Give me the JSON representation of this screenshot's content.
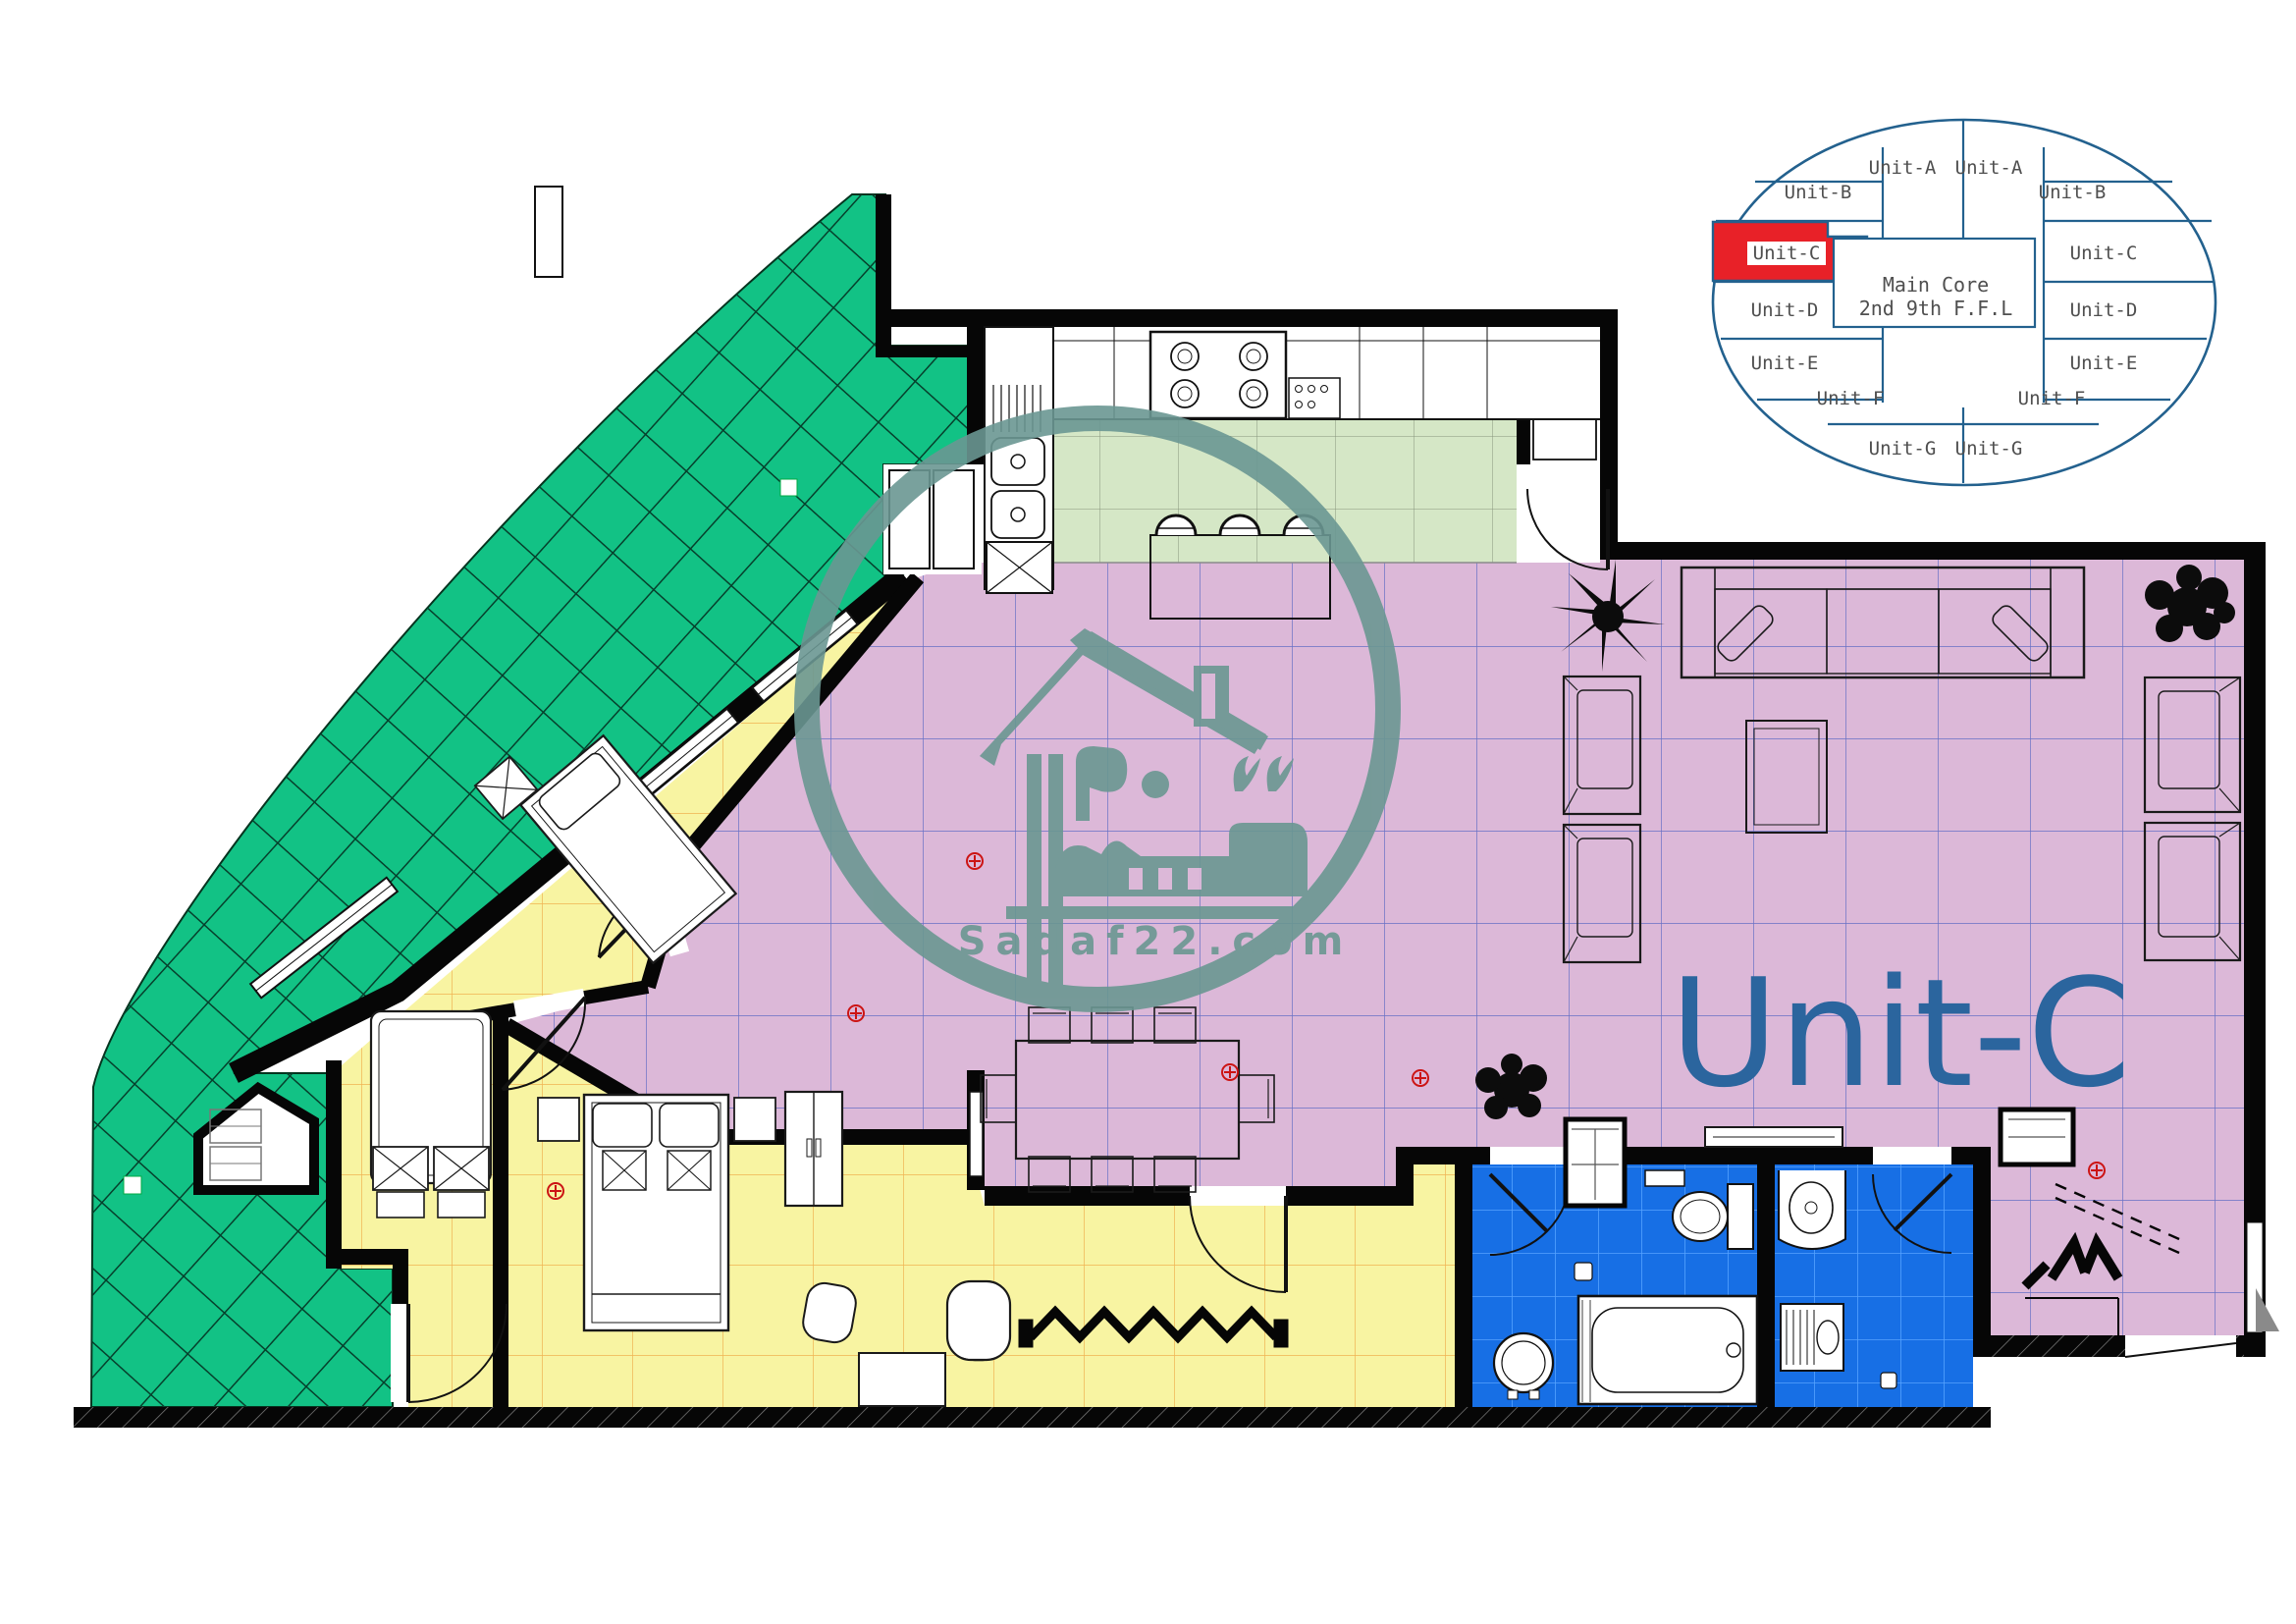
{
  "plan": {
    "unit_label": "Unit-C",
    "rooms": [
      {
        "name": "terrace",
        "color": "#12C285"
      },
      {
        "name": "kitchen",
        "color": "#D5E7C6"
      },
      {
        "name": "living-dining",
        "color": "#DCB8D8"
      },
      {
        "name": "bedroom-1",
        "color": "#F8F4A2"
      },
      {
        "name": "bedroom-2",
        "color": "#F8F4A2"
      },
      {
        "name": "master-bedroom",
        "color": "#F8F4A2"
      },
      {
        "name": "bathroom-1",
        "color": "#176FE5"
      },
      {
        "name": "bathroom-2",
        "color": "#176FE5"
      }
    ]
  },
  "key_plan": {
    "core_label_line1": "Main Core",
    "core_label_line2": "2nd  9th F.F.L",
    "highlighted_unit": "Unit-C",
    "outline_color": "#23618E",
    "highlight_color": "#E82128",
    "units": [
      {
        "label": "Unit-A"
      },
      {
        "label": "Unit-A"
      },
      {
        "label": "Unit-B"
      },
      {
        "label": "Unit-B"
      },
      {
        "label": "Unit-C",
        "highlighted": true
      },
      {
        "label": "Unit-C"
      },
      {
        "label": "Unit-D"
      },
      {
        "label": "Unit-D"
      },
      {
        "label": "Unit-E"
      },
      {
        "label": "Unit-E"
      },
      {
        "label": "Unit-F"
      },
      {
        "label": "Unit-F"
      },
      {
        "label": "Unit-G"
      },
      {
        "label": "Unit-G"
      }
    ]
  },
  "watermark": {
    "website": "Sadaf22.com",
    "logo_text_arabic": "صدف",
    "logo_number_arabic": "٢٢",
    "color": "#6A9792"
  },
  "colors": {
    "walls": "#060606",
    "terrace_grid": "#06402C",
    "bedroom_grid": "#ECA23E",
    "living_grid": "#4A5FC0",
    "bath_grid": "#55A2FF",
    "unit_text": "#2B659E"
  }
}
